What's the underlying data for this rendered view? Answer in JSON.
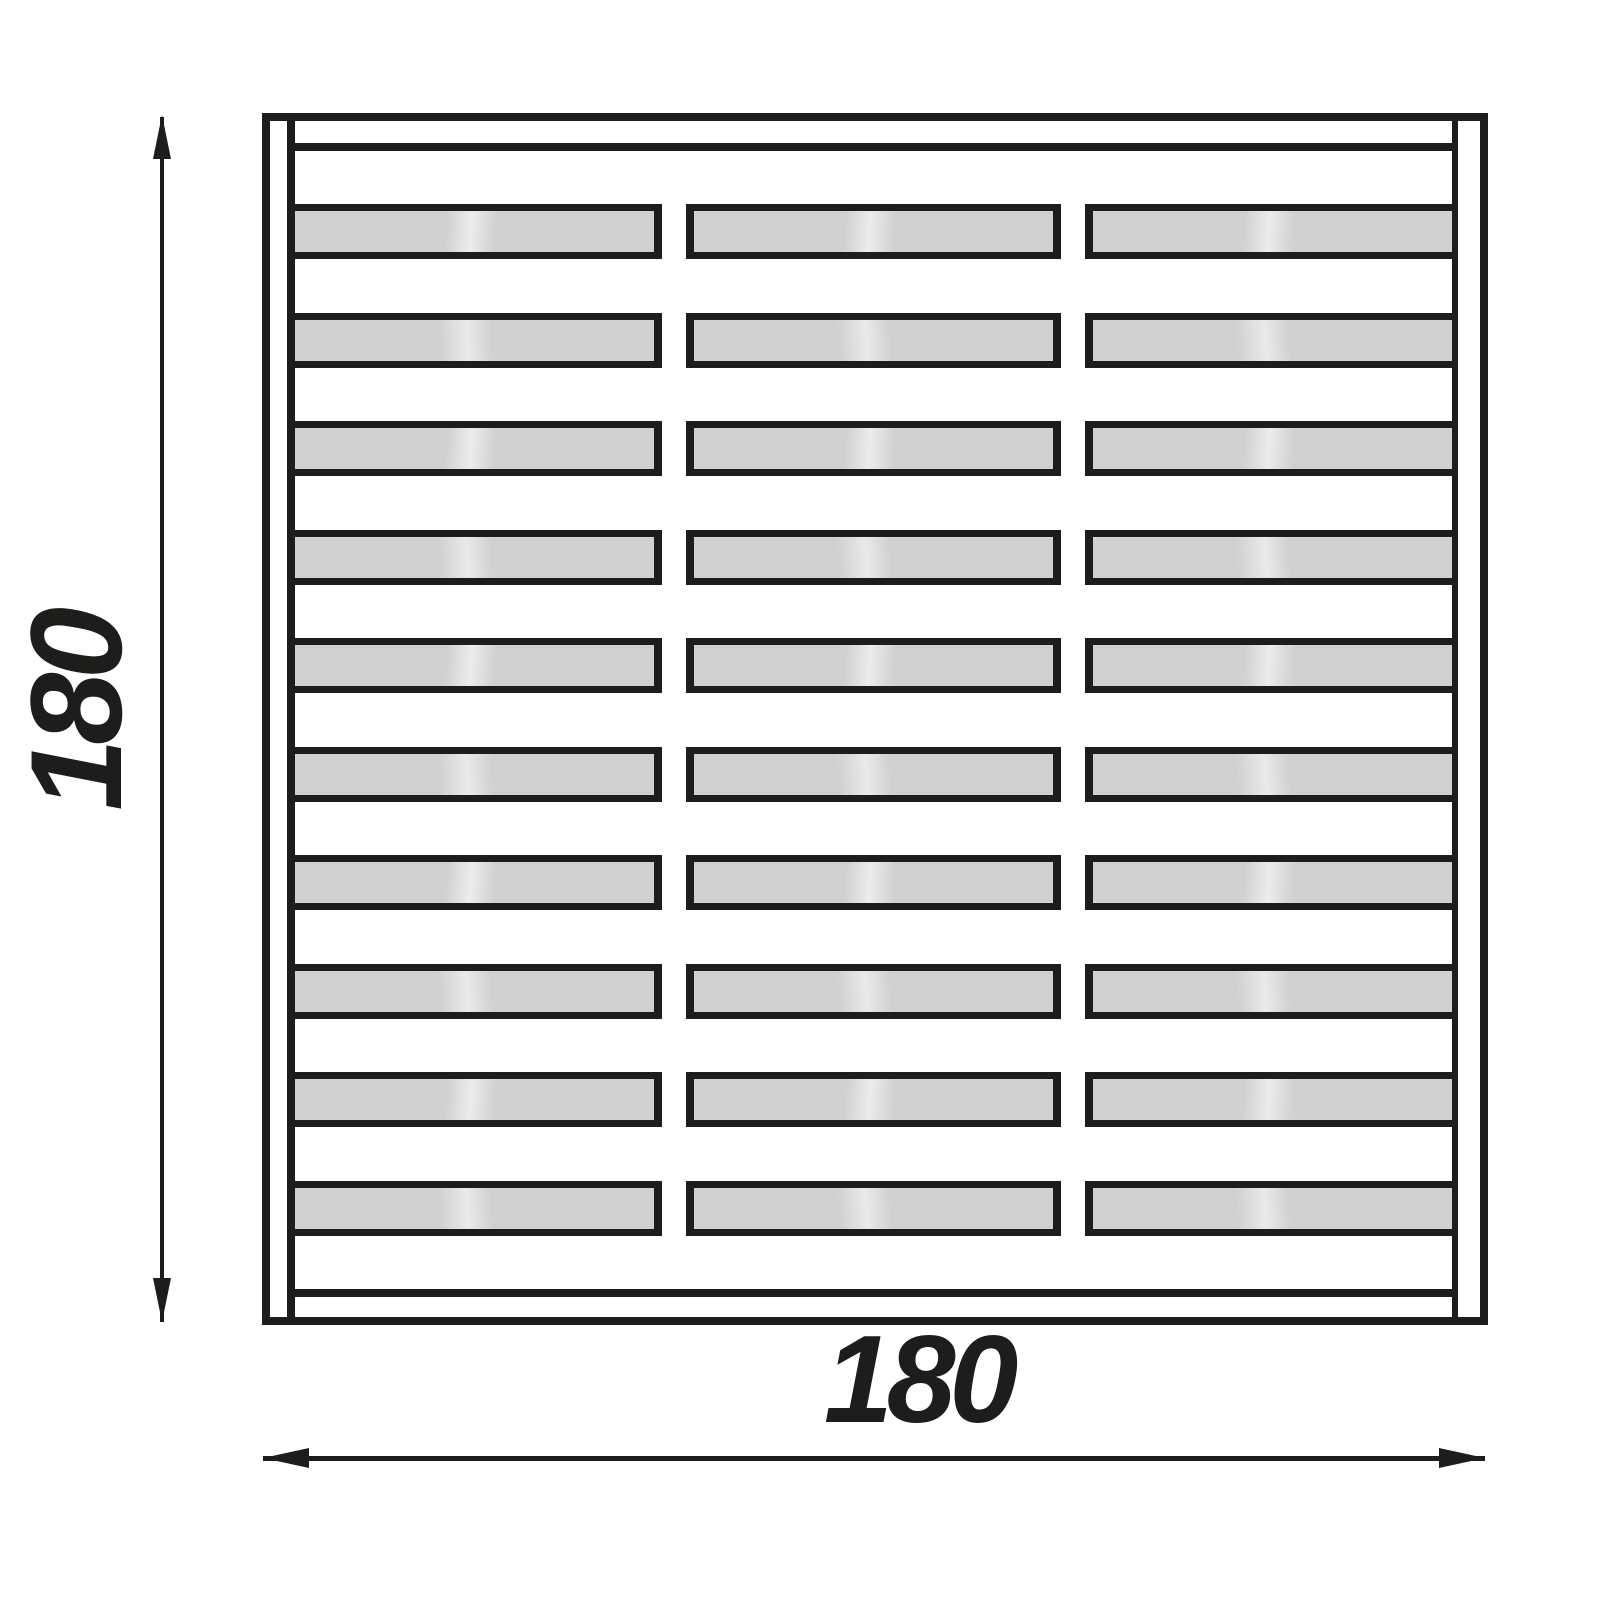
{
  "drawing": {
    "title": "Fence panel dimension drawing",
    "dimensions": {
      "height_label": "180",
      "width_label": "180"
    },
    "panel": {
      "board_rows": 10,
      "segments_per_board": 3,
      "dividers_per_board": 2
    },
    "colors": {
      "line": "#1d1d1b",
      "board_fill": "#d0d0d0",
      "background": "#ffffff"
    }
  }
}
